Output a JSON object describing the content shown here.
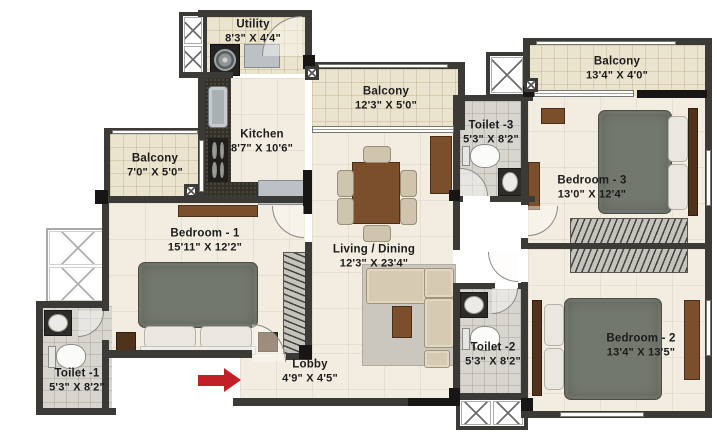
{
  "rooms": {
    "utility": {
      "name": "Utility",
      "dims": "8'3\" X 4'4\""
    },
    "kitchen": {
      "name": "Kitchen",
      "dims": "8'7\" X 10'6\""
    },
    "balcony_top": {
      "name": "Balcony",
      "dims": "12'3\" X 5'0\""
    },
    "balcony_right": {
      "name": "Balcony",
      "dims": "13'4\" X 4'0\""
    },
    "balcony_left": {
      "name": "Balcony",
      "dims": "7'0\" X 5'0\""
    },
    "toilet_3": {
      "name": "Toilet -3",
      "dims": "5'3\" X 8'2\""
    },
    "bedroom_3": {
      "name": "Bedroom - 3",
      "dims": "13'0\" X 12'4\""
    },
    "bedroom_1": {
      "name": "Bedroom - 1",
      "dims": "15'11\" X 12'2\""
    },
    "living_dining": {
      "name": "Living / Dining",
      "dims": "12'3\" X 23'4\""
    },
    "lobby": {
      "name": "Lobby",
      "dims": "4'9\" X 4'5\""
    },
    "toilet_1": {
      "name": "Toilet -1",
      "dims": "5'3\" X 8'2\""
    },
    "toilet_2": {
      "name": "Toilet -2",
      "dims": "5'3\" X 8'2\""
    },
    "bedroom_2": {
      "name": "Bedroom - 2",
      "dims": "13'4\" X 13'5\""
    }
  },
  "colors": {
    "wall": "#3c3a37",
    "floor": "#f2ece1",
    "balcony-tile": "#eae3cd",
    "toilet-tile": "#d8d5cf",
    "bed": "#73786e",
    "wood": "#7b4f2c",
    "sofa": "#d7cab2",
    "arrow": "#c22026"
  }
}
